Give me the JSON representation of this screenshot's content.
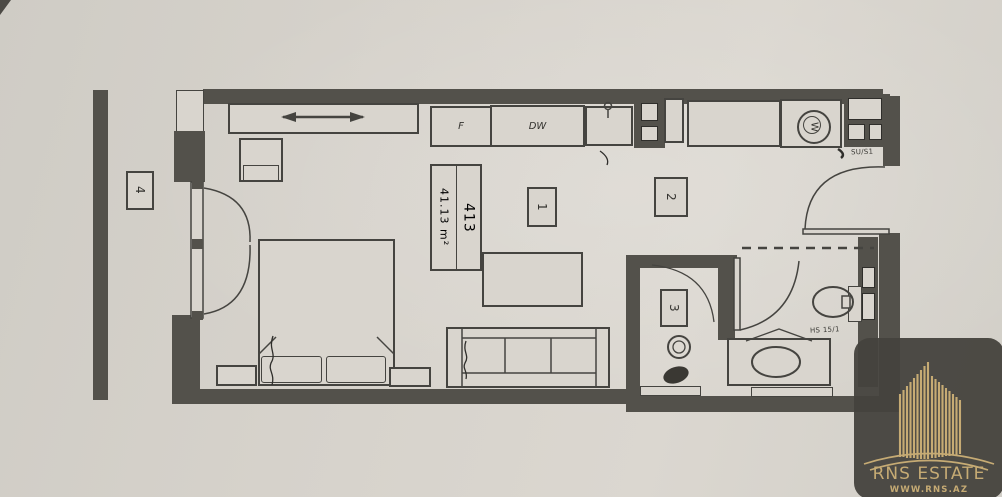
{
  "floorplan": {
    "unit_number": "413",
    "total_area": "41.13 m²",
    "rooms": {
      "room1": "1",
      "room2": "2",
      "room3": "3",
      "room4": "4"
    },
    "appliances": {
      "fridge": "F",
      "dishwasher": "DW",
      "washer": "W"
    },
    "annotations": {
      "label_top_right": "SU/S1",
      "label_bathroom": "HS 15/1"
    }
  },
  "watermark": {
    "brand": "RNS ESTATE",
    "website": "WWW.RNS.AZ"
  },
  "colors": {
    "paper": "#d7d3cc",
    "wall": "#53514b",
    "ink": "#3f3e3a",
    "gold": "#c6ab74",
    "logo_bg": "#45433e"
  }
}
